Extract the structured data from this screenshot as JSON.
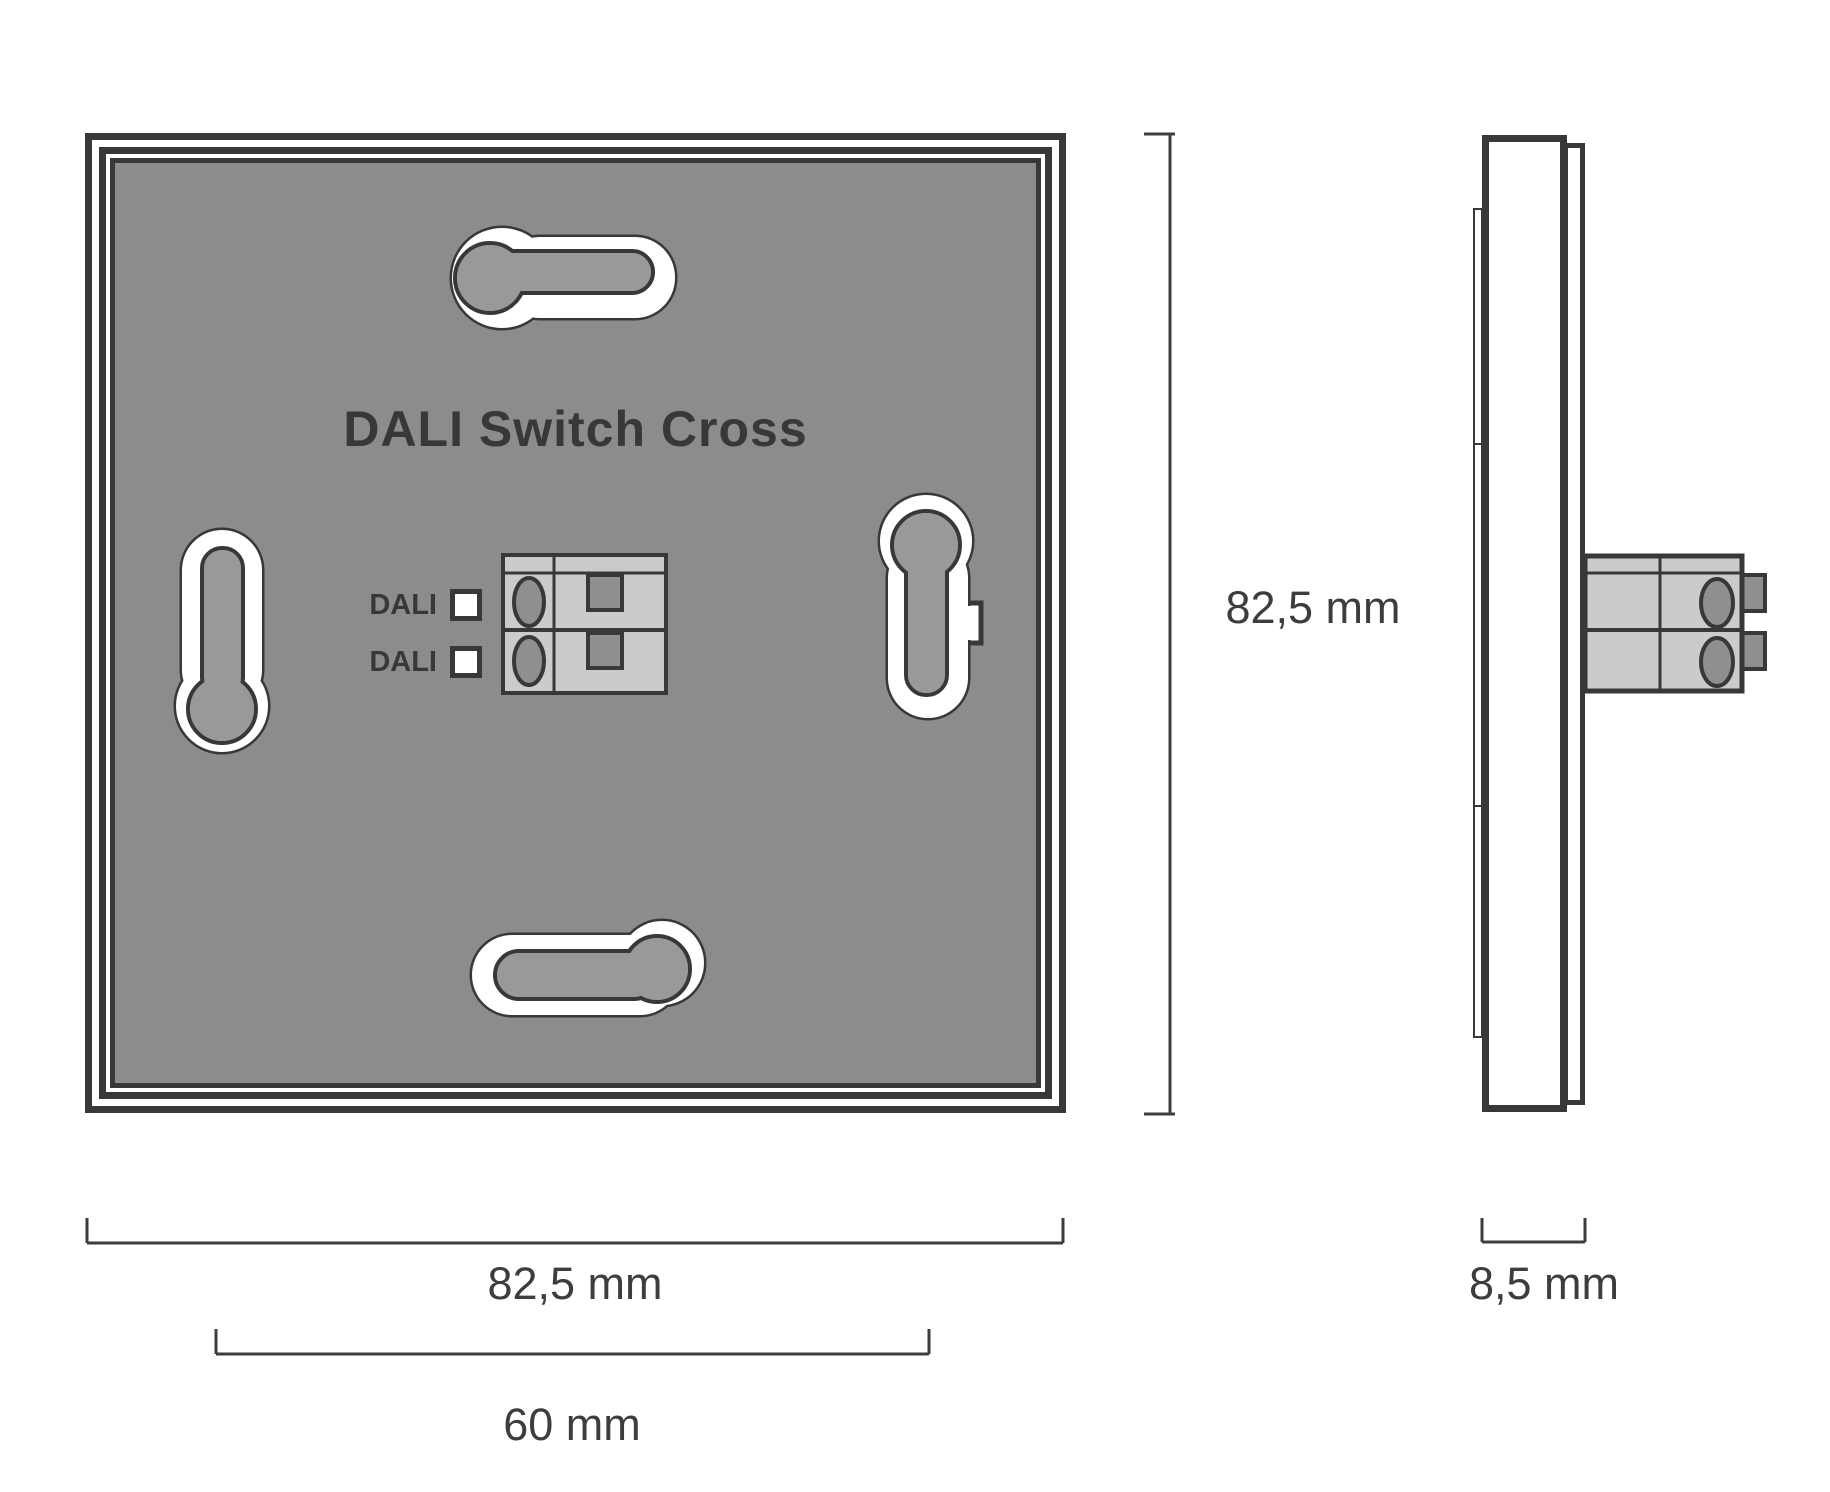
{
  "product": {
    "title": "DALI Switch Cross"
  },
  "front_view": {
    "terminal": {
      "labels": [
        "DALI",
        "DALI"
      ]
    }
  },
  "dimensions": {
    "height_label": "82,5 mm",
    "width_label": "82,5 mm",
    "inner_width_label": "60 mm",
    "depth_label": "8,5 mm"
  },
  "colors": {
    "line": "#383838",
    "panel_gray": "#8c8c8c",
    "slot_key_gray": "#999999",
    "terminal_body_gray": "#cbcbcb",
    "terminal_detail_gray": "#8f8f8f",
    "background": "#ffffff"
  }
}
